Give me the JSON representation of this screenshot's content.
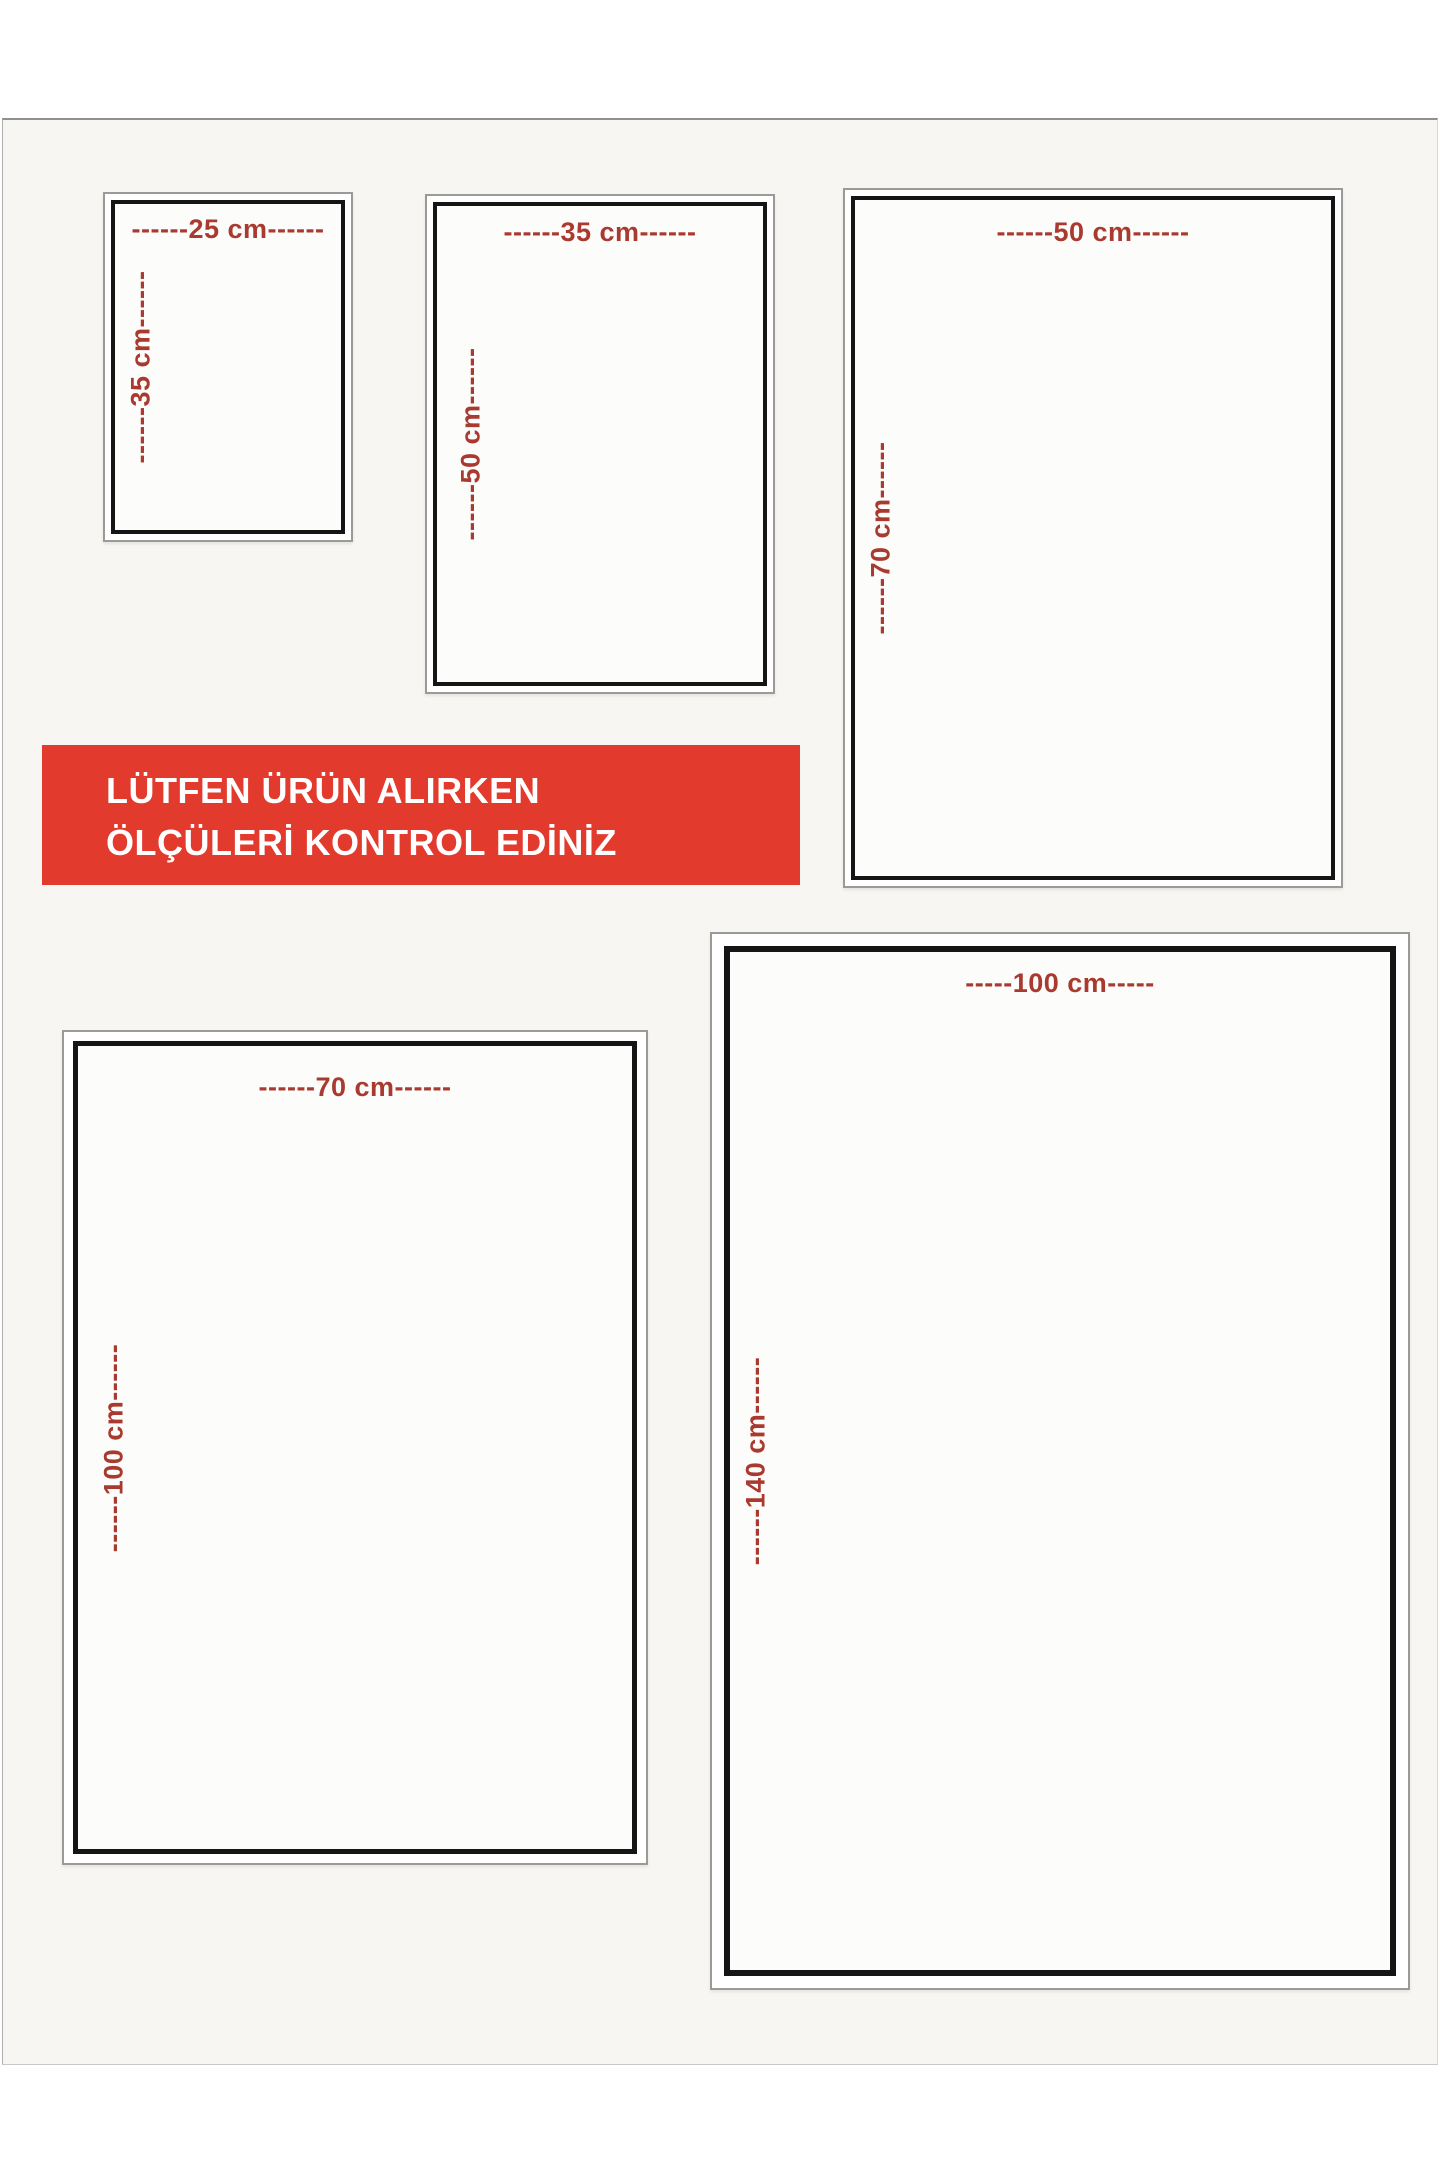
{
  "banner": {
    "line1": "LÜTFEN ÜRÜN ALIRKEN",
    "line2": "ÖLÇÜLERİ KONTROL EDİNİZ",
    "bg_color": "#e23a2d",
    "text_color": "#ffffff"
  },
  "colors": {
    "dimension_label": "#a93a2f",
    "box_border": "#151515",
    "outer_frame": "#9b9a97",
    "backdrop": "#f7f6f3"
  },
  "boxes": [
    {
      "id": "25x35",
      "width_cm": 25,
      "height_cm": 35,
      "width_label": "------25 cm------",
      "height_label": "------35 cm------"
    },
    {
      "id": "35x50",
      "width_cm": 35,
      "height_cm": 50,
      "width_label": "------35 cm------",
      "height_label": "------50 cm------"
    },
    {
      "id": "50x70",
      "width_cm": 50,
      "height_cm": 70,
      "width_label": "------50 cm------",
      "height_label": "------70 cm------"
    },
    {
      "id": "70x100",
      "width_cm": 70,
      "height_cm": 100,
      "width_label": "------70 cm------",
      "height_label": "------100 cm------"
    },
    {
      "id": "100x140",
      "width_cm": 100,
      "height_cm": 140,
      "width_label": "-----100 cm-----",
      "height_label": "------140 cm------"
    }
  ]
}
